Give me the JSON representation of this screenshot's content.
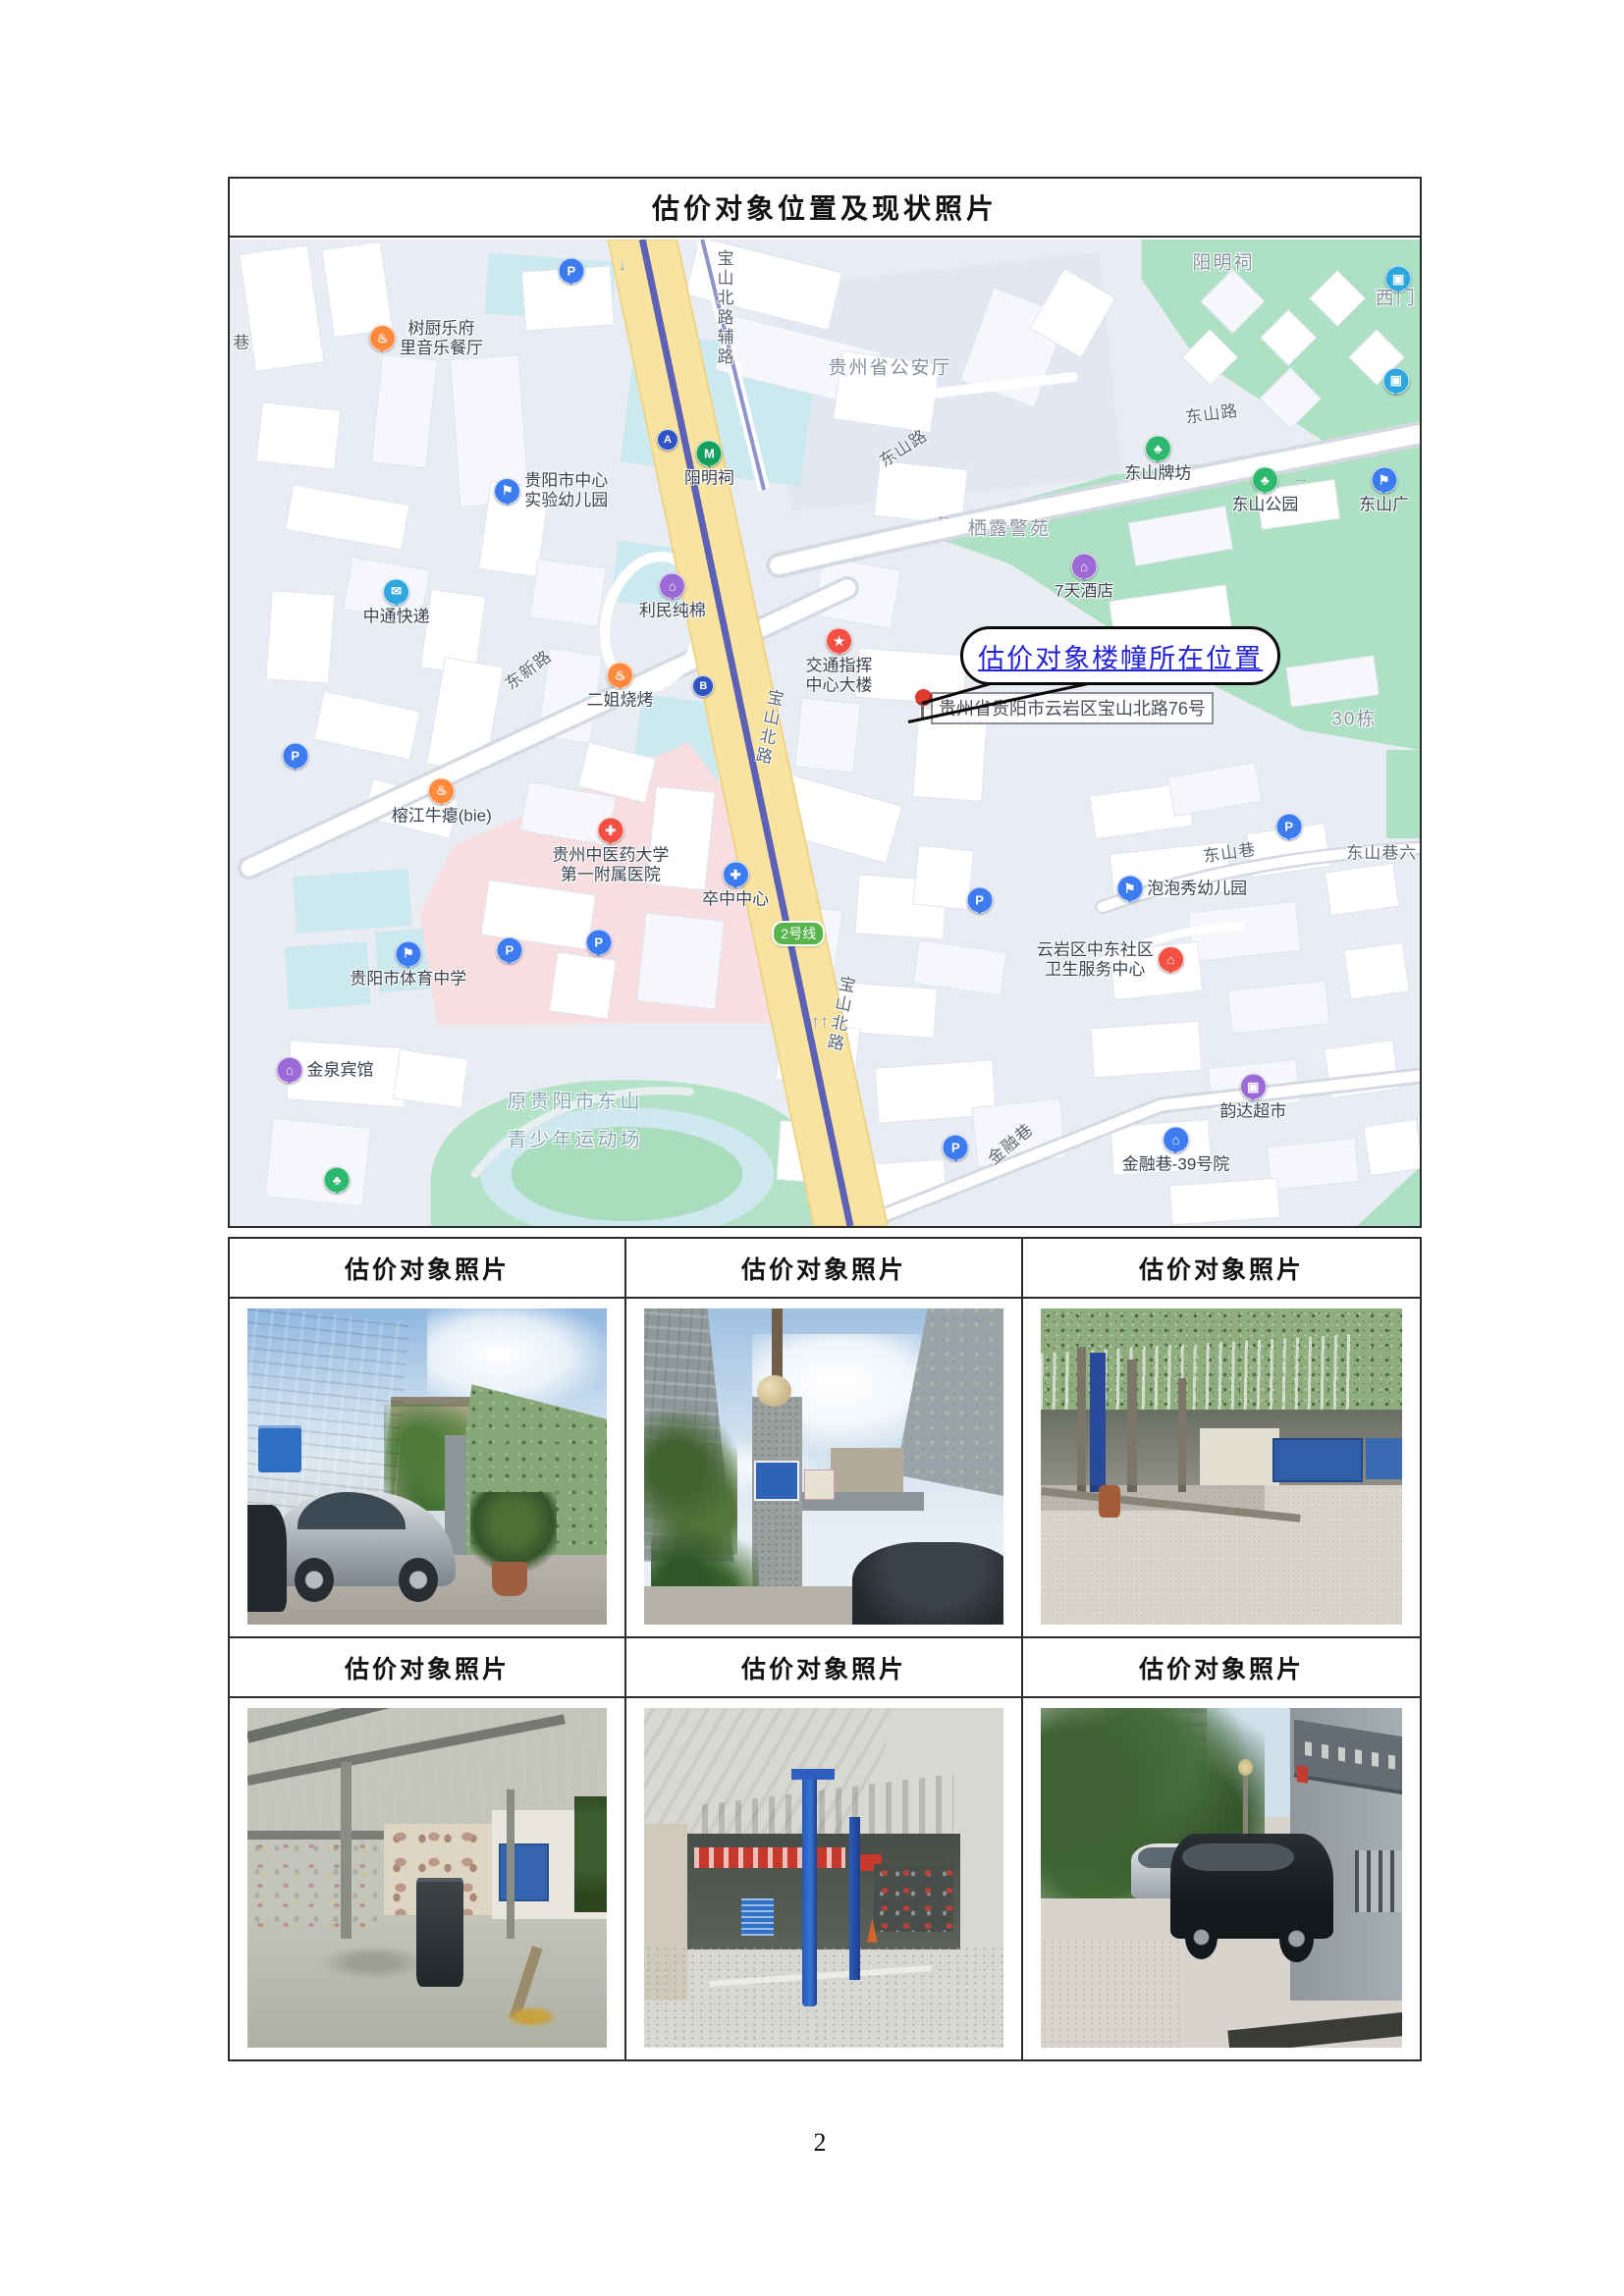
{
  "doc_title": "估价对象位置及现状照片",
  "page_number": "2",
  "photo_caption": "估价对象照片",
  "colors": {
    "road_yellow": "#f8e3a1",
    "metro_purple": "#5d61b5",
    "park_green": "#aee0c3",
    "water_blue": "#cde9f0",
    "hospital_pink": "#f8dee0",
    "annotation_blue": "#2323d6"
  },
  "map": {
    "annotation_text": "估价对象楼幢所在位置",
    "address_label": "贵州省贵阳市云岩区宝山北路76号",
    "metro_badge": "2号线",
    "labels": [
      {
        "t": "宝山北路辅路",
        "x": 41.5,
        "y": 7.0,
        "cls": "road",
        "vert": true
      },
      {
        "t": "东山路",
        "x": 56.5,
        "y": 21.0,
        "cls": "road",
        "rot": -33
      },
      {
        "t": "东山路",
        "x": 82.5,
        "y": 17.5,
        "cls": "road",
        "rot": -8
      },
      {
        "t": "东新路",
        "x": 25.0,
        "y": 43.5,
        "cls": "road",
        "rot": -37
      },
      {
        "t": "宝山北路",
        "x": 45.2,
        "y": 49.5,
        "cls": "road",
        "vert": true,
        "rot": 11
      },
      {
        "t": "宝山北路",
        "x": 51.2,
        "y": 78.5,
        "cls": "road",
        "vert": true,
        "rot": 11
      },
      {
        "t": "金融巷",
        "x": 65.5,
        "y": 91.5,
        "cls": "road",
        "rot": -40
      },
      {
        "t": "东山巷",
        "x": 84.0,
        "y": 62.0,
        "cls": "road",
        "rot": -8
      },
      {
        "t": "东山巷六",
        "x": 96.8,
        "y": 62.0,
        "cls": "road"
      },
      {
        "t": "巷",
        "x": 1.0,
        "y": 10.2,
        "cls": "road"
      },
      {
        "t": "30栋",
        "x": 94.5,
        "y": 48.5,
        "cls": "area"
      },
      {
        "t": "阳明祠",
        "x": 83.5,
        "y": 2.2,
        "cls": "area"
      },
      {
        "t": "贵州省公安厅",
        "x": 55.5,
        "y": 12.8,
        "cls": "area"
      },
      {
        "t": "栖露警苑",
        "x": 65.5,
        "y": 29.2,
        "cls": "area"
      },
      {
        "t": "西门",
        "x": 98.0,
        "y": 5.8,
        "cls": "area"
      },
      {
        "t": "原贵阳市东山",
        "x": 29.0,
        "y": 87.2,
        "cls": "park"
      },
      {
        "t": "青少年运动场",
        "x": 29.0,
        "y": 91.0,
        "cls": "park"
      }
    ],
    "pois": [
      {
        "lines": [
          "树厨乐府",
          "里音乐餐厅"
        ],
        "x": 16.5,
        "y": 10.0,
        "kind": "food",
        "ipos": "right"
      },
      {
        "lines": [
          "中通快递"
        ],
        "x": 14.0,
        "y": 36.8,
        "kind": "express",
        "ipos": "top"
      },
      {
        "lines": [
          "贵阳市中心",
          "实验幼儿园"
        ],
        "x": 27.0,
        "y": 25.5,
        "kind": "flag",
        "ipos": "right"
      },
      {
        "lines": [
          "阳明祠"
        ],
        "x": 40.3,
        "y": 22.8,
        "kind": "metro",
        "ipos": "top"
      },
      {
        "lines": [
          "利民纯棉"
        ],
        "x": 37.2,
        "y": 36.2,
        "kind": "hotel",
        "ipos": "top"
      },
      {
        "lines": [
          "二姐烧烤"
        ],
        "x": 32.8,
        "y": 45.3,
        "kind": "food",
        "ipos": "top"
      },
      {
        "lines": [
          "交通指挥",
          "中心大楼"
        ],
        "x": 51.2,
        "y": 42.8,
        "kind": "star",
        "ipos": "top"
      },
      {
        "lines": [
          "榕江牛瘪(bie)"
        ],
        "x": 17.8,
        "y": 57.0,
        "kind": "food",
        "ipos": "top"
      },
      {
        "lines": [
          "贵州中医药大学",
          "第一附属医院"
        ],
        "x": 32.0,
        "y": 62.0,
        "kind": "hospital",
        "ipos": "top"
      },
      {
        "lines": [
          "卒中中心"
        ],
        "x": 42.5,
        "y": 65.5,
        "kind": "clinic",
        "ipos": "top"
      },
      {
        "lines": [
          "7天酒店"
        ],
        "x": 71.8,
        "y": 34.2,
        "kind": "hotel",
        "ipos": "top"
      },
      {
        "lines": [
          "东山牌坊"
        ],
        "x": 78.0,
        "y": 22.3,
        "kind": "park",
        "ipos": "top"
      },
      {
        "lines": [
          "东山公园"
        ],
        "x": 87.0,
        "y": 25.5,
        "kind": "park",
        "ipos": "top"
      },
      {
        "lines": [
          "东山广"
        ],
        "x": 97.0,
        "y": 25.5,
        "kind": "blueflag",
        "ipos": "top"
      },
      {
        "lines": [
          "贵阳市体育中学"
        ],
        "x": 15.0,
        "y": 73.5,
        "kind": "flag",
        "ipos": "top"
      },
      {
        "lines": [
          "金泉宾馆"
        ],
        "x": 8.0,
        "y": 84.2,
        "kind": "hotel",
        "ipos": "right"
      },
      {
        "lines": [
          "泡泡秀幼儿园"
        ],
        "x": 80.0,
        "y": 65.8,
        "kind": "flag",
        "ipos": "right"
      },
      {
        "lines": [
          "云岩区中东社区",
          "卫生服务中心"
        ],
        "x": 74.0,
        "y": 73.0,
        "kind": "redhome",
        "ipos": "left"
      },
      {
        "lines": [
          "韵达超市"
        ],
        "x": 86.0,
        "y": 87.0,
        "kind": "market",
        "ipos": "top"
      },
      {
        "lines": [
          "金融巷-39号院"
        ],
        "x": 79.5,
        "y": 92.3,
        "kind": "bluehome",
        "ipos": "top"
      }
    ],
    "icons": [
      {
        "kind": "parking",
        "x": 28.7,
        "y": 3.2
      },
      {
        "kind": "parking",
        "x": 5.5,
        "y": 52.3
      },
      {
        "kind": "parking",
        "x": 23.5,
        "y": 72.0
      },
      {
        "kind": "parking",
        "x": 31.0,
        "y": 71.2
      },
      {
        "kind": "parking",
        "x": 63.0,
        "y": 67.0
      },
      {
        "kind": "parking",
        "x": 61.0,
        "y": 92.0
      },
      {
        "kind": "parking",
        "x": 89.0,
        "y": 59.5
      },
      {
        "kind": "exitA",
        "x": 36.8,
        "y": 20.3
      },
      {
        "kind": "exitB",
        "x": 39.8,
        "y": 45.3
      },
      {
        "kind": "bus",
        "x": 98.2,
        "y": 4.0
      },
      {
        "kind": "bus",
        "x": 98.0,
        "y": 14.3
      },
      {
        "kind": "tree",
        "x": 9.0,
        "y": 95.3
      },
      {
        "kind": "badge",
        "x": 47.8,
        "y": 70.3
      },
      {
        "kind": "arrow",
        "g": "↓",
        "x": 33.0,
        "y": 2.6
      },
      {
        "kind": "arrow",
        "g": "↑↑",
        "x": 49.6,
        "y": 79.3
      },
      {
        "kind": "arrow",
        "g": "←",
        "x": 60.0,
        "y": 28.0
      },
      {
        "kind": "arrow",
        "g": "→",
        "x": 90.0,
        "y": 24.2
      }
    ]
  },
  "photos": [
    {
      "desc": "Street view of subject building entrance with silver sedan and camouflage-net fence"
    },
    {
      "desc": "Gate pillar with signs, palm plants and surrounding buildings under cloudy sky"
    },
    {
      "desc": "Open steel-canopy parking shed with vehicle lift and blue container"
    },
    {
      "desc": "Interior of steel-frame workshop with waste bin and work benches"
    },
    {
      "desc": "Auto-repair shop front with blue two-post lifts under canopy"
    },
    {
      "desc": "Courtyard with parked black SUV beside office building entrance"
    }
  ]
}
